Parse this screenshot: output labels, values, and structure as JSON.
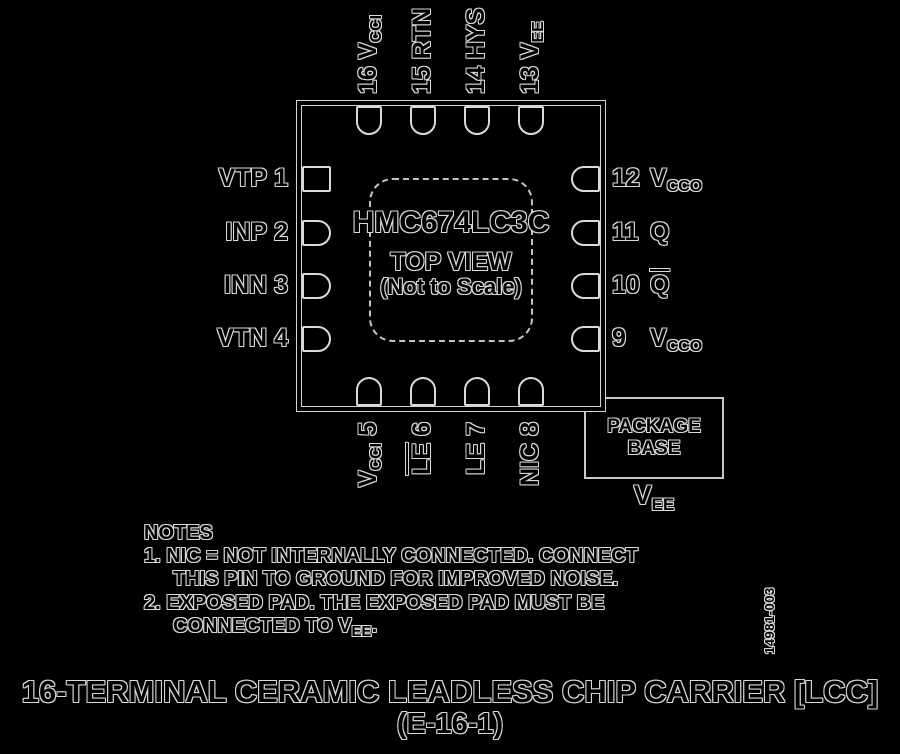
{
  "diagram": {
    "chip": {
      "part_number": "HMC674LC3C",
      "view": "TOP VIEW",
      "scale_note": "(Not to Scale)"
    },
    "pins": {
      "top": [
        {
          "num": "16",
          "main": "V",
          "sub": "CCI"
        },
        {
          "num": "15",
          "main": "RTN"
        },
        {
          "num": "14",
          "main": "HYS"
        },
        {
          "num": "13",
          "main": "V",
          "sub": "EE"
        }
      ],
      "left": [
        {
          "num": "1",
          "main": "VTP"
        },
        {
          "num": "2",
          "main": "INP"
        },
        {
          "num": "3",
          "main": "INN"
        },
        {
          "num": "4",
          "main": "VTN"
        }
      ],
      "right": [
        {
          "num": "12",
          "main": "V",
          "sub": "CCO"
        },
        {
          "num": "11",
          "main": "Q"
        },
        {
          "num": "10",
          "main": "Q",
          "bar": true
        },
        {
          "num": "9",
          "main": "V",
          "sub": "CCO"
        }
      ],
      "bottom": [
        {
          "num": "5",
          "main": "V",
          "sub": "CCI"
        },
        {
          "num": "6",
          "main": "LE",
          "bar": true
        },
        {
          "num": "7",
          "main": "LE"
        },
        {
          "num": "8",
          "main": "NIC"
        }
      ]
    },
    "package_base": {
      "line1": "PACKAGE",
      "line2": "BASE",
      "net_main": "V",
      "net_sub": "EE"
    },
    "notes": {
      "header": "NOTES",
      "lines": [
        {
          "text": "1. NIC = NOT INTERNALLY CONNECTED. CONNECT"
        },
        {
          "text": "THIS PIN TO GROUND FOR IMPROVED NOISE.",
          "indent": true
        },
        {
          "text": "2. EXPOSED PAD. THE EXPOSED PAD MUST BE"
        },
        {
          "text": "CONNECTED TO V",
          "sub": "EE",
          "tail": ".",
          "indent": true
        }
      ]
    },
    "figure_id": "14981-003",
    "title": {
      "line1": "16-TERMINAL CERAMIC LEADLESS CHIP CARRIER [LCC]",
      "line2": "(E-16-1)"
    },
    "colors": {
      "background": "#000000",
      "ink": "#000000",
      "halo": "#d9d9d9",
      "line": "#d4d4d4"
    }
  }
}
